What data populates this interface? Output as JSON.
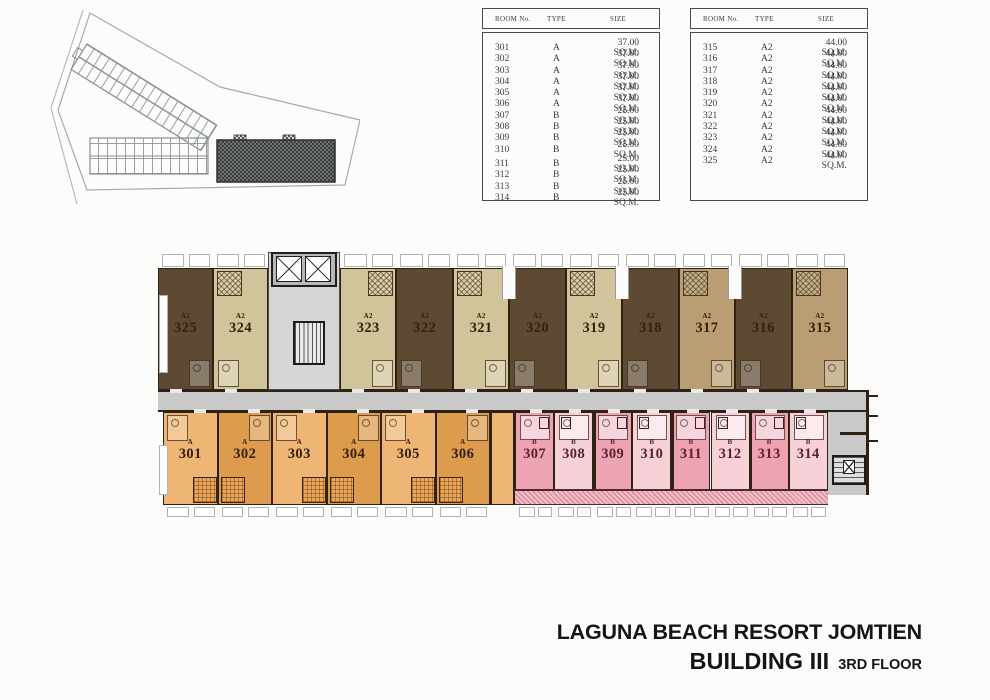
{
  "legend_tables": [
    {
      "headers": [
        "ROOM No.",
        "TYPE",
        "SIZE"
      ],
      "rows": [
        {
          "room": "301",
          "type": "A",
          "size": "37.00 SQ.M."
        },
        {
          "room": "302",
          "type": "A",
          "size": "37.00 SQ.M."
        },
        {
          "room": "303",
          "type": "A",
          "size": "37.00 SQ.M."
        },
        {
          "room": "304",
          "type": "A",
          "size": "37.00 SQ.M."
        },
        {
          "room": "305",
          "type": "A",
          "size": "37.00 SQ.M."
        },
        {
          "room": "306",
          "type": "A",
          "size": "37.00 SQ.M."
        },
        {
          "room": "307",
          "type": "B",
          "size": "25.00 SQ.M."
        },
        {
          "room": "308",
          "type": "B",
          "size": "25.00 SQ.M."
        },
        {
          "room": "309",
          "type": "B",
          "size": "25.00 SQ.M."
        },
        {
          "room": "310",
          "type": "B",
          "size": "25.00 SQ.M."
        },
        {
          "room": "311",
          "type": "B",
          "size": "25.00 SQ.M."
        },
        {
          "room": "312",
          "type": "B",
          "size": "25.00 SQ.M."
        },
        {
          "room": "313",
          "type": "B",
          "size": "25.00 SQ.M."
        },
        {
          "room": "314",
          "type": "B",
          "size": "25.00 SQ.M."
        }
      ]
    },
    {
      "headers": [
        "ROOM No.",
        "TYPE",
        "SIZE"
      ],
      "rows": [
        {
          "room": "315",
          "type": "A2",
          "size": "44.00 SQ.M."
        },
        {
          "room": "316",
          "type": "A2",
          "size": "44.00 SQ.M."
        },
        {
          "room": "317",
          "type": "A2",
          "size": "44.00 SQ.M."
        },
        {
          "room": "318",
          "type": "A2",
          "size": "44.00 SQ.M."
        },
        {
          "room": "319",
          "type": "A2",
          "size": "44.00 SQ.M."
        },
        {
          "room": "320",
          "type": "A2",
          "size": "44.00 SQ.M."
        },
        {
          "room": "321",
          "type": "A2",
          "size": "44.00 SQ.M."
        },
        {
          "room": "322",
          "type": "A2",
          "size": "44.00 SQ.M."
        },
        {
          "room": "323",
          "type": "A2",
          "size": "44.00 SQ.M."
        },
        {
          "room": "324",
          "type": "A2",
          "size": "44.00 SQ.M."
        },
        {
          "room": "325",
          "type": "A2",
          "size": "44.00 SQ.M."
        }
      ]
    }
  ],
  "floor_plan": {
    "top_row": [
      {
        "no": "325",
        "type": "A2",
        "shade": "dark"
      },
      {
        "no": "324",
        "type": "A2",
        "shade": "light"
      },
      {
        "no": "323",
        "type": "A2",
        "shade": "light"
      },
      {
        "no": "322",
        "type": "A2",
        "shade": "dark"
      },
      {
        "no": "321",
        "type": "A2",
        "shade": "light"
      },
      {
        "no": "320",
        "type": "A2",
        "shade": "dark"
      },
      {
        "no": "319",
        "type": "A2",
        "shade": "light"
      },
      {
        "no": "318",
        "type": "A2",
        "shade": "dark"
      },
      {
        "no": "317",
        "type": "A2",
        "shade": "med"
      },
      {
        "no": "316",
        "type": "A2",
        "shade": "dark"
      },
      {
        "no": "315",
        "type": "A2",
        "shade": "med"
      }
    ],
    "bottom_row": [
      {
        "no": "301",
        "type": "A",
        "shade": "ol"
      },
      {
        "no": "302",
        "type": "A",
        "shade": "od"
      },
      {
        "no": "303",
        "type": "A",
        "shade": "ol"
      },
      {
        "no": "304",
        "type": "A",
        "shade": "od"
      },
      {
        "no": "305",
        "type": "A",
        "shade": "ol"
      },
      {
        "no": "306",
        "type": "A",
        "shade": "od"
      },
      {
        "no": "307",
        "type": "B",
        "shade": "pd"
      },
      {
        "no": "308",
        "type": "B",
        "shade": "pl"
      },
      {
        "no": "309",
        "type": "B",
        "shade": "pd"
      },
      {
        "no": "310",
        "type": "B",
        "shade": "pl"
      },
      {
        "no": "311",
        "type": "B",
        "shade": "pd"
      },
      {
        "no": "312",
        "type": "B",
        "shade": "pl"
      },
      {
        "no": "313",
        "type": "B",
        "shade": "pd"
      },
      {
        "no": "314",
        "type": "B",
        "shade": "pl"
      }
    ],
    "colors": {
      "room-dark": "#5e4a33",
      "room-light": "#d2c49a",
      "room-med": "#b89e72",
      "orange-light": "#efb574",
      "orange-dark": "#dd9b4e",
      "pink-dark": "#eda3b2",
      "pink-light": "#f6d2d8",
      "corridor": "#c9c9c9",
      "wall": "#2e2215",
      "label-brown": "#33200f",
      "label-pink": "#5c1f2d"
    }
  },
  "title": {
    "line1": "LAGUNA BEACH RESORT JOMTIEN",
    "building": "BUILDING III",
    "floor": "3RD FLOOR"
  }
}
